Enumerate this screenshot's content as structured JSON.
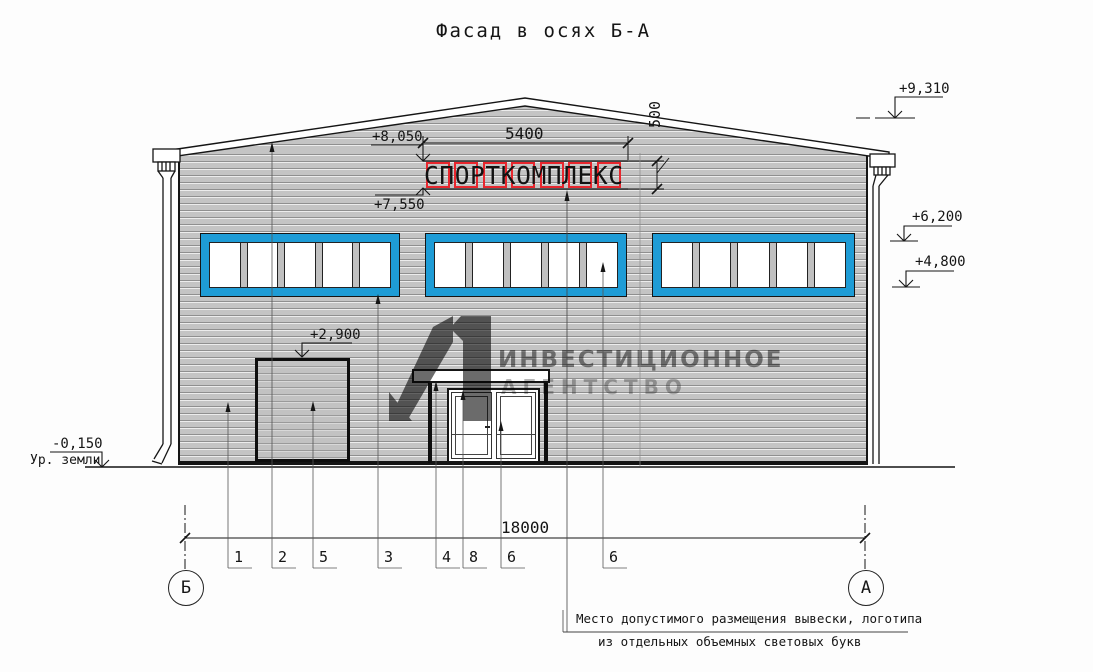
{
  "title": "Фасад в осях Б-А",
  "sign": {
    "text": "СПОРТКОМПЛЕКС"
  },
  "dimensions": {
    "sign_width": "5400",
    "sign_height": "500",
    "total_width": "18000"
  },
  "elevations": {
    "ridge": "+9,310",
    "sign_top": "+8,050",
    "sign_bottom": "+7,550",
    "windows_top": "+6,200",
    "windows_bottom": "+4,800",
    "gate_top": "+2,900",
    "ground": "-0,150"
  },
  "labels": {
    "ground_level": "Ур. земли"
  },
  "axes": {
    "left": "Б",
    "right": "А"
  },
  "callouts": [
    "1",
    "2",
    "5",
    "3",
    "4",
    "8",
    "6",
    "6"
  ],
  "note": {
    "line1": "Место допустимого размещения вывески, логотипа",
    "line2": "из отдельных объемных световых букв"
  },
  "watermark": {
    "line1": "ИНВЕСТИЦИОННОЕ",
    "line2": "АГЕНТСТВО"
  },
  "colors": {
    "window_frame": "#1e9cd6",
    "sign_box": "#e8262d",
    "wall": "#c4c4c4",
    "watermark": "#5a5a5a"
  }
}
